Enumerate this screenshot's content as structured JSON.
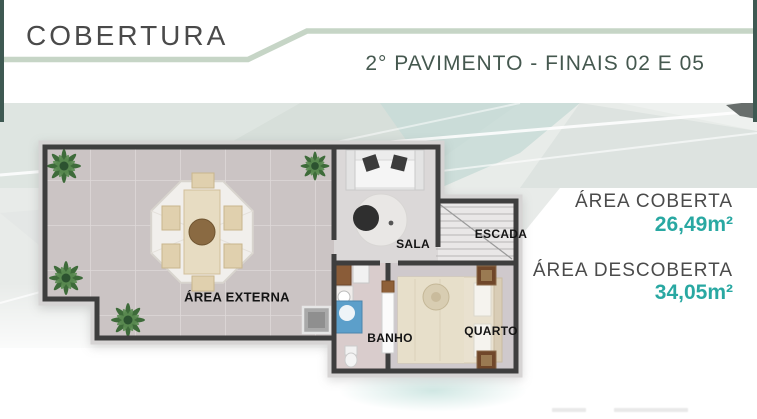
{
  "header": {
    "title": "COBERTURA",
    "subtitle": "2° PAVIMENTO - FINAIS 02 E 05"
  },
  "floor_plan": {
    "rooms": [
      {
        "label": "ÁREA EXTERNA"
      },
      {
        "label": "SALA"
      },
      {
        "label": "ESCADA"
      },
      {
        "label": "BANHO"
      },
      {
        "label": "QUARTO"
      }
    ]
  },
  "areas": [
    {
      "label": "ÁREA COBERTA",
      "value": "26,49m²"
    },
    {
      "label": "ÁREA DESCOBERTA",
      "value": "34,05m²"
    }
  ],
  "icons": {
    "plant": "potted-plant-top-view-icon",
    "gazebo": "octagonal-gazebo-dining-icon",
    "stairs": "staircase-icon"
  },
  "colors": {
    "title_gray": "#4a4a4a",
    "subtitle_green": "#45584f",
    "accent_teal": "#29a8a2",
    "line_sage": "#c6d5c6",
    "edge_bar": "#3e5952",
    "wall": "#3e3e3e"
  }
}
